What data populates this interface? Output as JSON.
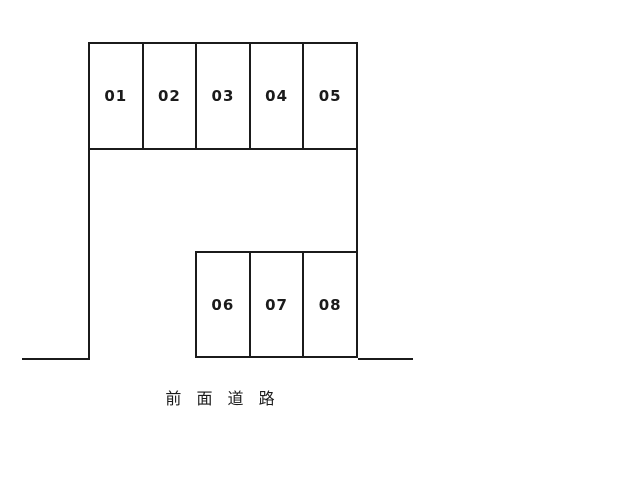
{
  "parking": {
    "top_row": [
      "01",
      "02",
      "03",
      "04",
      "05"
    ],
    "bottom_row": [
      "06",
      "07",
      "08"
    ],
    "road_label": "前 面 道 路",
    "colors": {
      "line": "#1b1b1b",
      "background": "#ffffff",
      "label": "#1b1b1b"
    }
  }
}
